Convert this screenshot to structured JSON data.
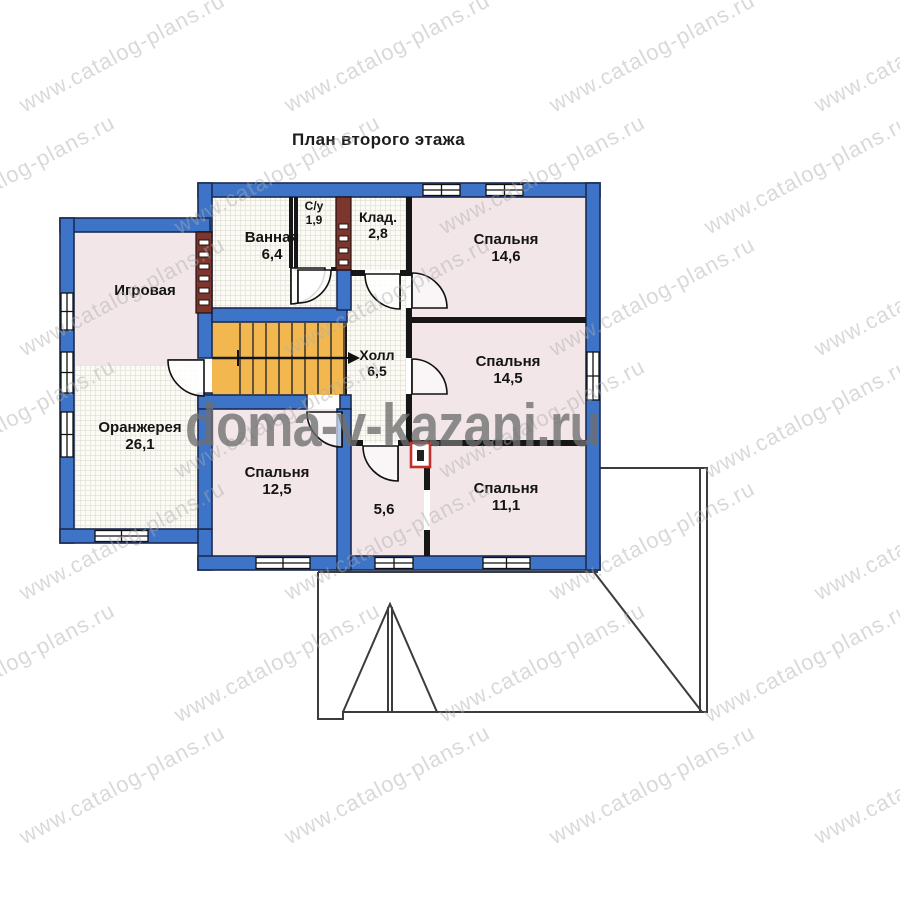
{
  "title": "План второго этажа",
  "watermarks": {
    "site_large": "doma-v-kazani.ru",
    "site_tiled": "www.catalog-plans.ru"
  },
  "rooms": [
    {
      "name": "Игровая",
      "area": ""
    },
    {
      "name": "Ванная",
      "area": "6,4"
    },
    {
      "name": "С/у",
      "area": "1,9"
    },
    {
      "name": "Клад.",
      "area": "2,8"
    },
    {
      "name": "Спальня",
      "area": "14,6"
    },
    {
      "name": "Спальня",
      "area": "14,5"
    },
    {
      "name": "Холл",
      "area": "6,5"
    },
    {
      "name": "Оранжерея",
      "area": "26,1"
    },
    {
      "name": "Спальня",
      "area": "12,5"
    },
    {
      "name": "",
      "area": "5,6"
    },
    {
      "name": "Спальня",
      "area": "11,1"
    }
  ],
  "colors": {
    "wall_blue": "#3d74c7",
    "wall_outline": "#1b2b52",
    "interior_wall": "#161616",
    "floor_pink": "#f3e6e8",
    "hatch_bg": "#fbfaf5",
    "hatch_grid": "#d9d8cc",
    "stair_orange": "#f2b84f",
    "shaft_brown": "#7c362e",
    "flue_red": "#c2302a",
    "roof_line": "#3c3c3c",
    "watermark_gray": "#8c8c8c"
  }
}
